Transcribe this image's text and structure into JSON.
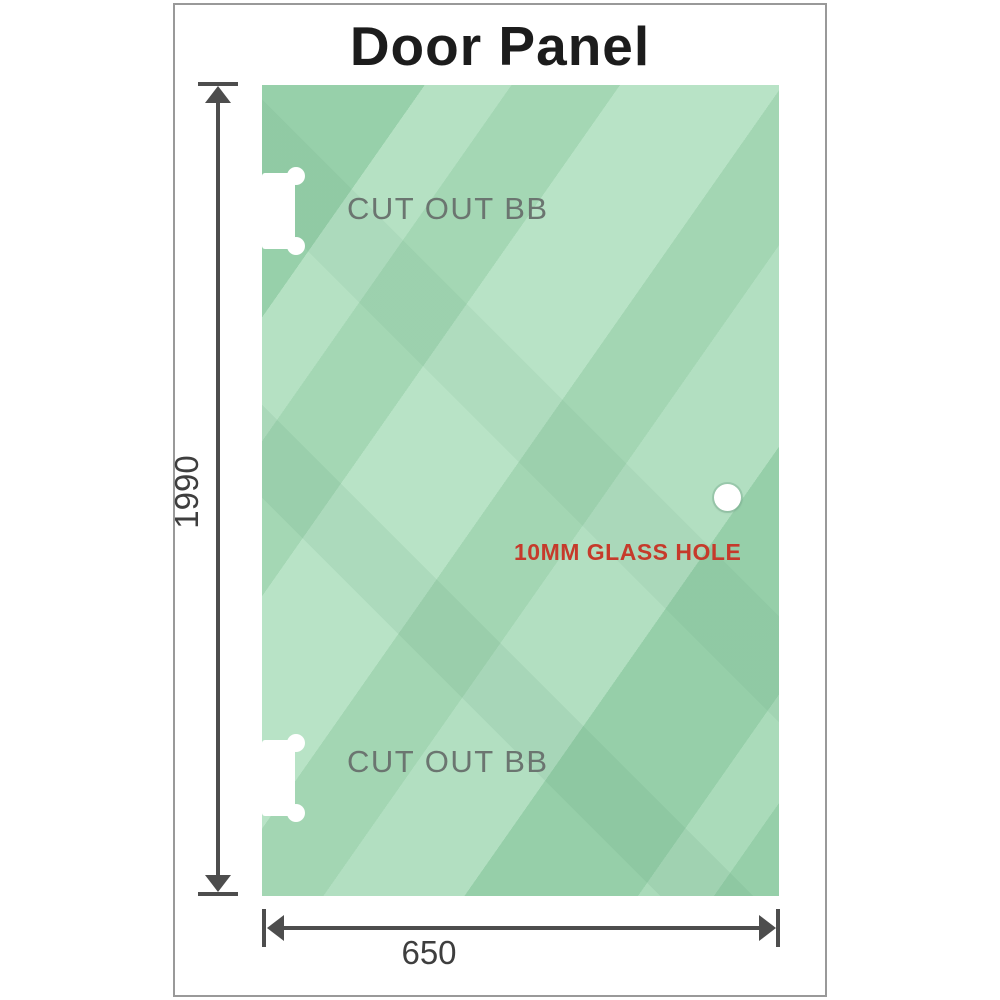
{
  "title": "Door Panel",
  "panel": {
    "cutouts": [
      {
        "label": "CUT OUT BB"
      },
      {
        "label": "CUT OUT BB"
      }
    ],
    "hole_label": "10MM GLASS HOLE"
  },
  "dimensions": {
    "height": "1990",
    "width": "650"
  },
  "colors": {
    "glass_green": "#98d1ab",
    "glass_highlight": "#b8e3c6",
    "hole_label_red": "#c63a2b",
    "dimension_line_gray": "#4d4d4d",
    "cutout_label_gray": "#6b7570",
    "frame_border_gray": "#999999",
    "title_black": "#1c1c1c"
  }
}
